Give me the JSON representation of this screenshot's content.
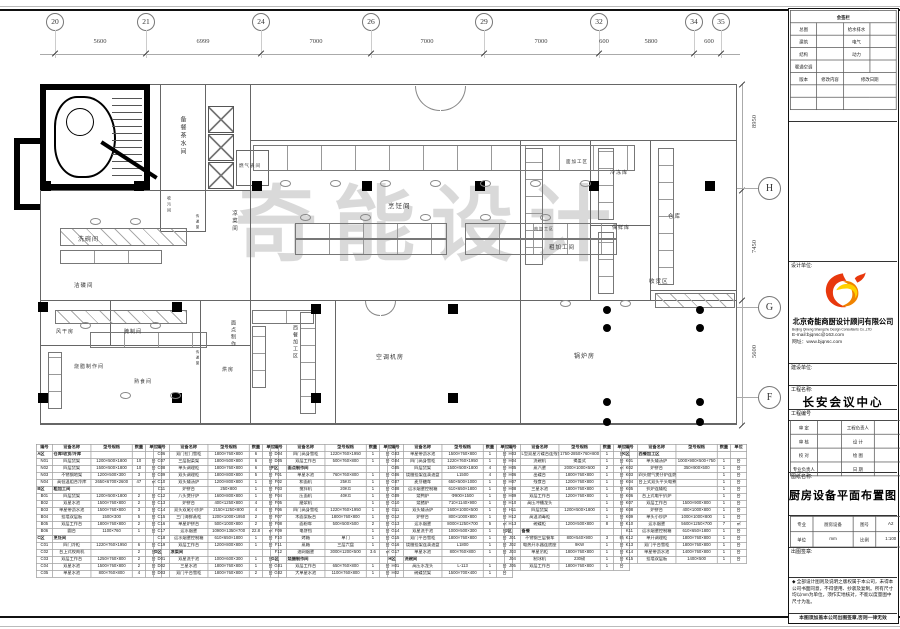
{
  "drawing": {
    "sheet_title": "厨房设备平面布置图",
    "watermark": "奇能设计"
  },
  "grid": {
    "top_bubbles": [
      {
        "label": "20",
        "x": 55
      },
      {
        "label": "21",
        "x": 146
      },
      {
        "label": "24",
        "x": 261
      },
      {
        "label": "26",
        "x": 371
      },
      {
        "label": "29",
        "x": 484
      },
      {
        "label": "32",
        "x": 599
      },
      {
        "label": "34",
        "x": 694
      },
      {
        "label": "35",
        "x": 721
      }
    ],
    "top_dims": [
      {
        "text": "5600",
        "x": 100
      },
      {
        "text": "6999",
        "x": 203
      },
      {
        "text": "7000",
        "x": 316
      },
      {
        "text": "7000",
        "x": 427
      },
      {
        "text": "7000",
        "x": 541
      },
      {
        "text": "600",
        "x": 604
      },
      {
        "text": "5800",
        "x": 651
      },
      {
        "text": "600",
        "x": 709
      }
    ],
    "right_bubbles": [
      {
        "label": "H",
        "y": 188
      },
      {
        "label": "G",
        "y": 307
      },
      {
        "label": "F",
        "y": 397
      }
    ],
    "right_dims": [
      {
        "text": "8950",
        "y": 118
      },
      {
        "text": "7450",
        "y": 243
      },
      {
        "text": "5600",
        "y": 348
      }
    ]
  },
  "plan": {
    "rooms": [
      {
        "t": "备餐茶水间",
        "x": 178,
        "y": 116,
        "v": 1,
        "s": 6
      },
      {
        "t": "燃气表间",
        "x": 239,
        "y": 163,
        "v": 0,
        "s": 4.5
      },
      {
        "t": "烹饪间",
        "x": 388,
        "y": 200,
        "v": 0,
        "s": 6.5
      },
      {
        "t": "凉菜间",
        "x": 230,
        "y": 210,
        "v": 1,
        "s": 5.5
      },
      {
        "t": "洗碗间",
        "x": 78,
        "y": 234,
        "v": 0,
        "s": 6
      },
      {
        "t": "收污间",
        "x": 166,
        "y": 196,
        "v": 1,
        "s": 4
      },
      {
        "t": "传递窗",
        "x": 196,
        "y": 214,
        "v": 1,
        "s": 3.5
      },
      {
        "t": "传递窗",
        "x": 196,
        "y": 350,
        "v": 1,
        "s": 3.5
      },
      {
        "t": "面加工区",
        "x": 566,
        "y": 159,
        "v": 0,
        "s": 4.5
      },
      {
        "t": "冷冻库",
        "x": 610,
        "y": 169,
        "v": 0,
        "s": 5
      },
      {
        "t": "保鲜库",
        "x": 612,
        "y": 224,
        "v": 0,
        "s": 5
      },
      {
        "t": "仓库",
        "x": 668,
        "y": 212,
        "v": 0,
        "s": 5.5
      },
      {
        "t": "肉加工区",
        "x": 534,
        "y": 226,
        "v": 0,
        "s": 4
      },
      {
        "t": "粗加工间",
        "x": 549,
        "y": 243,
        "v": 0,
        "s": 5.5
      },
      {
        "t": "收货区",
        "x": 649,
        "y": 277,
        "v": 0,
        "s": 5.5
      },
      {
        "t": "锅炉房",
        "x": 574,
        "y": 351,
        "v": 0,
        "s": 6
      },
      {
        "t": "空调机房",
        "x": 376,
        "y": 352,
        "v": 0,
        "s": 6
      },
      {
        "t": "西餐加工区",
        "x": 292,
        "y": 325,
        "v": 1,
        "s": 5
      },
      {
        "t": "洁碟间",
        "x": 74,
        "y": 281,
        "v": 0,
        "s": 5.5
      },
      {
        "t": "风干房",
        "x": 56,
        "y": 328,
        "v": 0,
        "s": 5
      },
      {
        "t": "腌制间",
        "x": 124,
        "y": 328,
        "v": 0,
        "s": 5
      },
      {
        "t": "烧腊制作间",
        "x": 74,
        "y": 363,
        "v": 0,
        "s": 5
      },
      {
        "t": "熟食间",
        "x": 134,
        "y": 378,
        "v": 0,
        "s": 5
      },
      {
        "t": "面点制作",
        "x": 230,
        "y": 320,
        "v": 1,
        "s": 5
      },
      {
        "t": "烘房",
        "x": 222,
        "y": 366,
        "v": 0,
        "s": 5
      }
    ]
  },
  "tables": {
    "headers": [
      "编号",
      "设备名称",
      "型号规格",
      "数量",
      "单位"
    ],
    "blocks": [
      [
        [
          "A区",
          "仓库/收货/冷库",
          "",
          "",
          ""
        ],
        [
          "N01",
          "四层货架",
          "1200×500×1800",
          "10",
          "台"
        ],
        [
          "N02",
          "四层货架",
          "1500×500×1800",
          "10",
          "台"
        ],
        [
          "N03",
          "不锈钢地架",
          "1200×500×300",
          "3",
          "台"
        ],
        [
          "N04",
          "高低温组合冷库",
          "2650×6700×2600",
          "47",
          "㎡"
        ],
        [
          "B区",
          "粗加工间",
          "",
          "",
          ""
        ],
        [
          "B01",
          "四层货架",
          "1200×500×1800",
          "2",
          "台"
        ],
        [
          "B02",
          "双星水池",
          "1500×760×800",
          "2",
          "台"
        ],
        [
          "B03",
          "单星带沥水池",
          "1500×760×800",
          "3",
          "台"
        ],
        [
          "B04",
          "挂墙双层板",
          "1500×300",
          "5",
          "台"
        ],
        [
          "B05",
          "双层工作台",
          "1800×760×800",
          "2",
          "台"
        ],
        [
          "B06",
          "圆台",
          "1100×760",
          "1",
          "台"
        ],
        [
          "C区",
          "烹饪间",
          "",
          "",
          ""
        ],
        [
          "C01",
          "四门冷柜",
          "1220×760×1950",
          "6",
          "台"
        ],
        [
          "C02",
          "台上式绞肉机",
          "",
          "2",
          "台"
        ],
        [
          "C03",
          "双层工作台",
          "1250×760×800",
          "2",
          "台"
        ],
        [
          "C04",
          "双星水池",
          "1500×760×800",
          "2",
          "台"
        ],
        [
          "C05",
          "单星水池",
          "800×760×800",
          "4",
          "台"
        ]
      ],
      [
        [
          "C06",
          "双门拉门雪柜",
          "1800×760×800",
          "6",
          "台"
        ],
        [
          "C07",
          "三层配菜架",
          "1800×500×800",
          "6",
          "台"
        ],
        [
          "C08",
          "单头调理柜",
          "1800×760×800",
          "6",
          "台"
        ],
        [
          "C09",
          "双头调理柜",
          "1800×800×800",
          "5",
          "台"
        ],
        [
          "C10",
          "双头矮汤炉",
          "1200×800×800",
          "1",
          "台"
        ],
        [
          "C11",
          "炉拼台",
          "250×800",
          "1",
          "台"
        ],
        [
          "C12",
          "八头煲仔炉",
          "1600×800×800",
          "1",
          "台"
        ],
        [
          "C13",
          "炉拼台",
          "400×1250×800",
          "4",
          "台"
        ],
        [
          "C14",
          "双头双尾小炒炉",
          "2150×1250×800",
          "4",
          "台"
        ],
        [
          "C15",
          "三门海鲜蒸柜",
          "1200×1000×1950",
          "2",
          "台"
        ],
        [
          "C16",
          "单星炉拼台",
          "500×1000×800",
          "2",
          "台"
        ],
        [
          "C17",
          "运水烟罩",
          "10900×1350×700",
          "22.8",
          "㎡"
        ],
        [
          "C18",
          "运水烟罩控制箱",
          "610×650×1800",
          "1",
          "台"
        ],
        [
          "C19",
          "双层工作台",
          "1200×800×800",
          "1",
          "台"
        ],
        [
          "D区",
          "凉菜间",
          "",
          "",
          ""
        ],
        [
          "D01",
          "双星洗手池",
          "1000×600×300",
          "1",
          "台"
        ],
        [
          "D02",
          "三星水池",
          "1800×760×800",
          "1",
          "台"
        ],
        [
          "D03",
          "双门平台雪柜",
          "1800×760×800",
          "2",
          "台"
        ]
      ],
      [
        [
          "D04",
          "四门高身雪柜",
          "1220×760×1950",
          "1",
          "台"
        ],
        [
          "D05",
          "双层工作台",
          "500×760×800",
          "1",
          "台"
        ],
        [
          "F区",
          "面点制作间",
          "",
          "",
          ""
        ],
        [
          "F01",
          "单星水池",
          "760×760×800",
          "1",
          "台"
        ],
        [
          "F02",
          "和面机",
          "25KG",
          "1",
          "台"
        ],
        [
          "F03",
          "搅拌机",
          "20KG",
          "1",
          "台"
        ],
        [
          "F04",
          "压面机",
          "40KG",
          "1",
          "台"
        ],
        [
          "F05",
          "磨浆机",
          "",
          "1",
          "台"
        ],
        [
          "F06",
          "四门高身雪柜",
          "1220×760×1950",
          "1",
          "台"
        ],
        [
          "F07",
          "木面案板台",
          "1800×760×800",
          "1",
          "台"
        ],
        [
          "F08",
          "面粉车",
          "500×500×500",
          "2",
          "台"
        ],
        [
          "F09",
          "电饼铛",
          "",
          "1",
          "台"
        ],
        [
          "F10",
          "烤箱",
          "单门",
          "1",
          "台"
        ],
        [
          "F11",
          "蒸箱",
          "三层六盘",
          "1",
          "台"
        ],
        [
          "F12",
          "油网烟罩",
          "3000×1200×500",
          "3.6",
          "㎡"
        ],
        [
          "G区",
          "烧腊制作间",
          "",
          "",
          ""
        ],
        [
          "G01",
          "双层工作台",
          "650×760×800",
          "1",
          "台"
        ],
        [
          "G02",
          "大单星水池",
          "1100×760×800",
          "1",
          "台"
        ]
      ],
      [
        [
          "G03",
          "单星带沥水池",
          "1500×760×800",
          "1",
          "台"
        ],
        [
          "G04",
          "四门高身雪柜",
          "1220×760×1950",
          "1",
          "台"
        ],
        [
          "G05",
          "四层货架",
          "1500×500×1800",
          "4",
          "台"
        ],
        [
          "G06",
          "烧腊挂架连滴油盘",
          "L1500",
          "4",
          "台"
        ],
        [
          "G07",
          "麦芽糖车",
          "650×500×1000",
          "1",
          "台"
        ],
        [
          "G08",
          "运水烟罩控制箱",
          "610×650×1800",
          "1",
          "台"
        ],
        [
          "G09",
          "烧鸭炉",
          "Φ900×1500",
          "1",
          "台"
        ],
        [
          "G10",
          "烧猪炉",
          "710×1140×900",
          "1",
          "台"
        ],
        [
          "G11",
          "双头矮汤炉",
          "1600×1000×500",
          "1",
          "台"
        ],
        [
          "G12",
          "炉拼台",
          "800×1000×800",
          "1",
          "台"
        ],
        [
          "G13",
          "运水烟罩",
          "8000×1250×700",
          "5",
          "㎡"
        ],
        [
          "G14",
          "双星洗手池",
          "1000×500×300",
          "1",
          "台"
        ],
        [
          "G15",
          "双门平台雪柜",
          "1800×760×800",
          "1",
          "台"
        ],
        [
          "G16",
          "烧腊挂架连滴油盘",
          "L1800",
          "1",
          "台"
        ],
        [
          "G17",
          "单星水池",
          "800×760×800",
          "1",
          "台"
        ],
        [
          "H区",
          "洗碗间",
          "",
          "",
          ""
        ],
        [
          "H01",
          "高压水龙头",
          "L-113",
          "1",
          "台"
        ],
        [
          "H02",
          "碗碟货架",
          "1500×700×400",
          "1",
          "台"
        ]
      ],
      [
        [
          "H03",
          "L型双星污碟台连残食台",
          "1750-2850×760×800",
          "1",
          "台"
        ],
        [
          "H04",
          "洗碗机",
          "揭盖式",
          "1",
          "台"
        ],
        [
          "H05",
          "蒸汽罩",
          "2000×1000×500",
          "2",
          "㎡"
        ],
        [
          "H06",
          "出碟台",
          "1800×760×800",
          "1",
          "台"
        ],
        [
          "H07",
          "残食台",
          "1200×760×800",
          "1",
          "台"
        ],
        [
          "H08",
          "三星水池",
          "1800×760×800",
          "1",
          "台"
        ],
        [
          "H09",
          "双层工作台",
          "1200×760×800",
          "1",
          "台"
        ],
        [
          "H10",
          "高压冲槽龙头",
          "",
          "1",
          "台"
        ],
        [
          "H11",
          "四层货架",
          "1200×500×1800",
          "1",
          "台"
        ],
        [
          "H12",
          "高温消毒柜",
          "",
          "1",
          "台"
        ],
        [
          "H13",
          "碗碟柜",
          "1200×500×800",
          "8",
          "台"
        ],
        [
          "J区",
          "备餐",
          "",
          "",
          ""
        ],
        [
          "J01",
          "不锈钢三层餐车",
          "800×540×900",
          "3",
          "辆"
        ],
        [
          "J02",
          "电热开水器连底座",
          "9KW",
          "1",
          "台"
        ],
        [
          "J03",
          "单星吊柜",
          "1800×760×800",
          "1",
          "台"
        ],
        [
          "J04",
          "制冰机",
          "230磅",
          "1",
          "台"
        ],
        [
          "J05",
          "双层工作台",
          "1800×760×800",
          "1",
          "台"
        ]
      ],
      [
        [
          "K区",
          "西餐加工区",
          "",
          "",
          ""
        ],
        [
          "K01",
          "单头矮汤炉",
          "1000×900×500+750",
          "1",
          "台"
        ],
        [
          "K02",
          "炉拼台",
          "350×900×500",
          "1",
          "台"
        ],
        [
          "K03",
          "四头燃气煲仔炉连燃气焗炉",
          "",
          "1",
          "台"
        ],
        [
          "K04",
          "台上式双头平头电煮炉",
          "",
          "1",
          "台"
        ],
        [
          "K05",
          "扒炉连矮柜",
          "",
          "1",
          "台"
        ],
        [
          "K06",
          "台上式电平扒炉",
          "",
          "1",
          "台"
        ],
        [
          "K07",
          "双层工作台",
          "1500×900×800",
          "1",
          "台"
        ],
        [
          "K08",
          "炉拼台",
          "400×1000×800",
          "1",
          "台"
        ],
        [
          "K09",
          "单头小炒炉",
          "1000×1000×800",
          "1",
          "台"
        ],
        [
          "K10",
          "运水烟罩",
          "5600×1250×700",
          "7",
          "㎡"
        ],
        [
          "K11",
          "运水烟罩控制箱",
          "610×650×1800",
          "1",
          "台"
        ],
        [
          "K12",
          "单开调理柜",
          "1800×760×800",
          "1",
          "台"
        ],
        [
          "K13",
          "双门平台雪柜",
          "1800×760×800",
          "1",
          "台"
        ],
        [
          "K14",
          "单星带沥水池",
          "1400×760×800",
          "1",
          "台"
        ],
        [
          "K15",
          "挂墙双层板",
          "1400×500",
          "1",
          "台"
        ]
      ]
    ]
  },
  "titleblock": {
    "sign_title": "会签栏",
    "sign_rows": [
      [
        "总图",
        "",
        "给水排水",
        ""
      ],
      [
        "建筑",
        "",
        "电气",
        ""
      ],
      [
        "结构",
        "",
        "动力",
        ""
      ],
      [
        "暖通空调",
        "",
        "",
        ""
      ]
    ],
    "rev_header": [
      "版本",
      "修改内容",
      "修改日期"
    ],
    "design_unit_label": "设计单位:",
    "company_cn": "北京奇能商厨设计顾问有限公司",
    "company_en": "Beijing Qineng Shangchu Design Consultants Co.,LTD",
    "email": "E-mail:bjqnsc@163.com",
    "website": "网址：www.bjqnsc.com",
    "client_label": "建设单位:",
    "project_label": "工程名称:",
    "project_name": "长安会议中心",
    "project_no_label": "工程编号",
    "approval_rows": [
      [
        "审 定",
        "工程负责人"
      ],
      [
        "审 核",
        "设 计"
      ],
      [
        "校 对",
        "绘 图"
      ],
      [
        "专业负责人",
        "日 期"
      ]
    ],
    "sheet_name_label": "图纸名称:",
    "sheet_name": "厨房设备平面布置图",
    "spec_rows": [
      [
        "专业",
        "厨房设备",
        "图号",
        "A2"
      ],
      [
        "单位",
        "mm",
        "比例",
        "1:100"
      ]
    ],
    "seal_label": "出图签章:",
    "disclaimer": "◆ 全部设计图则及说明之版权属于本公司，未得本公司书面同意，不得使用、抄袭及复制。所有尺寸均以mm为单位，须作实地核对，不能以度量图中尺寸为准。",
    "footer": "本图须加盖本公司出图签章,否则一律无效"
  }
}
